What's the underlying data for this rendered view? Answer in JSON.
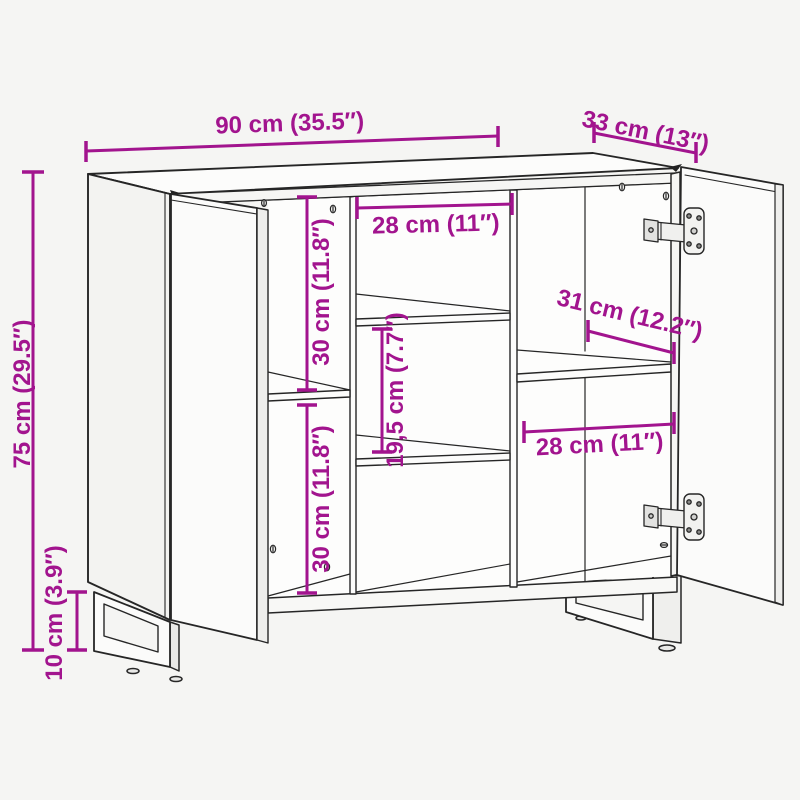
{
  "diagram": {
    "kind": "product-dimension-diagram",
    "subject": "sideboard with two open doors, interior shelves and U-shaped metal legs",
    "background_color": "#f5f5f3",
    "line_color": "#262626",
    "accent_color": "#a2148e"
  },
  "labels": {
    "width": "90 cm (35.5″)",
    "depth": "33 cm (13″)",
    "height": "75 cm (29.5″)",
    "leg_height": "10 cm (3.9″)",
    "left_upper_compartment": "30 cm (11.8″)",
    "left_lower_compartment": "30 cm (11.8″)",
    "middle_compartment_width": "28 cm (11″)",
    "middle_shelf_spacing": "19,5 cm (7.7″)",
    "shelf_depth": "31 cm (12.2″)",
    "right_compartment_width": "28 cm (11″)"
  }
}
